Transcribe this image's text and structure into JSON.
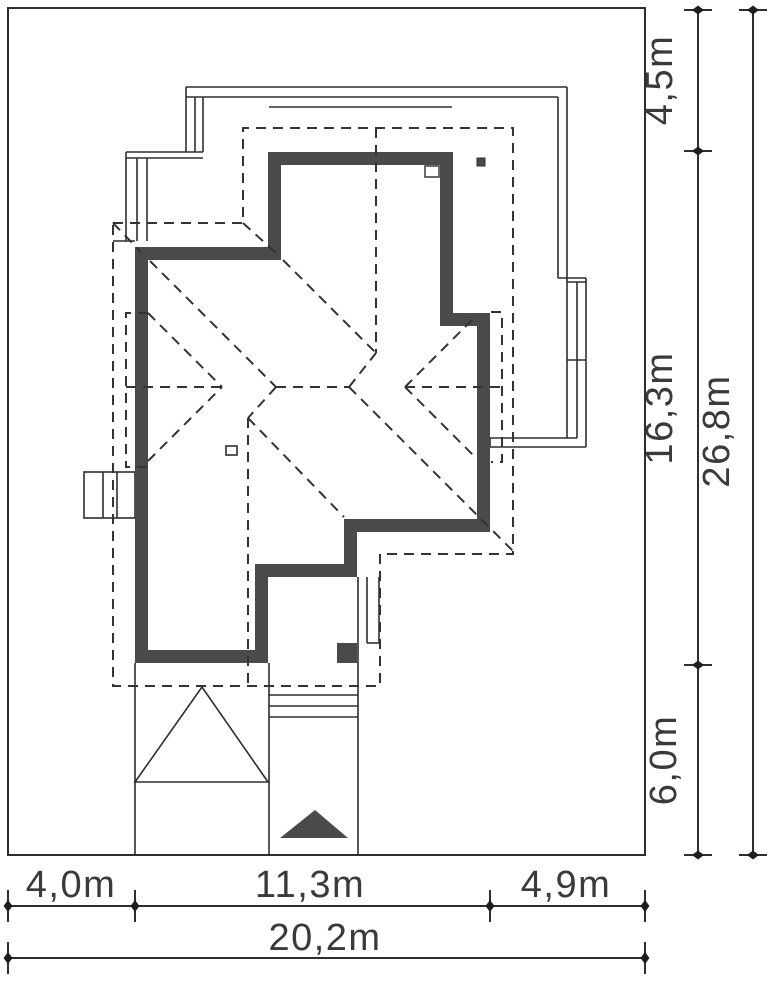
{
  "drawing": {
    "type": "house-roof-site-plan",
    "colors": {
      "background": "#ffffff",
      "wall_fill": "#4a4a4a",
      "thin_line": "#2e2e2e",
      "dash_line": "#333333",
      "dim_line": "#2e2e2e",
      "text": "#3a3a3a"
    }
  },
  "dimensions": {
    "right": [
      {
        "label": "4,5m"
      },
      {
        "label": "16,3m"
      },
      {
        "label": "6,0m"
      }
    ],
    "right_total": {
      "label": "26,8m"
    },
    "bottom": [
      {
        "label": "4,0m"
      },
      {
        "label": "11,3m"
      },
      {
        "label": "4,9m"
      }
    ],
    "bottom_total": {
      "label": "20,2m"
    }
  }
}
